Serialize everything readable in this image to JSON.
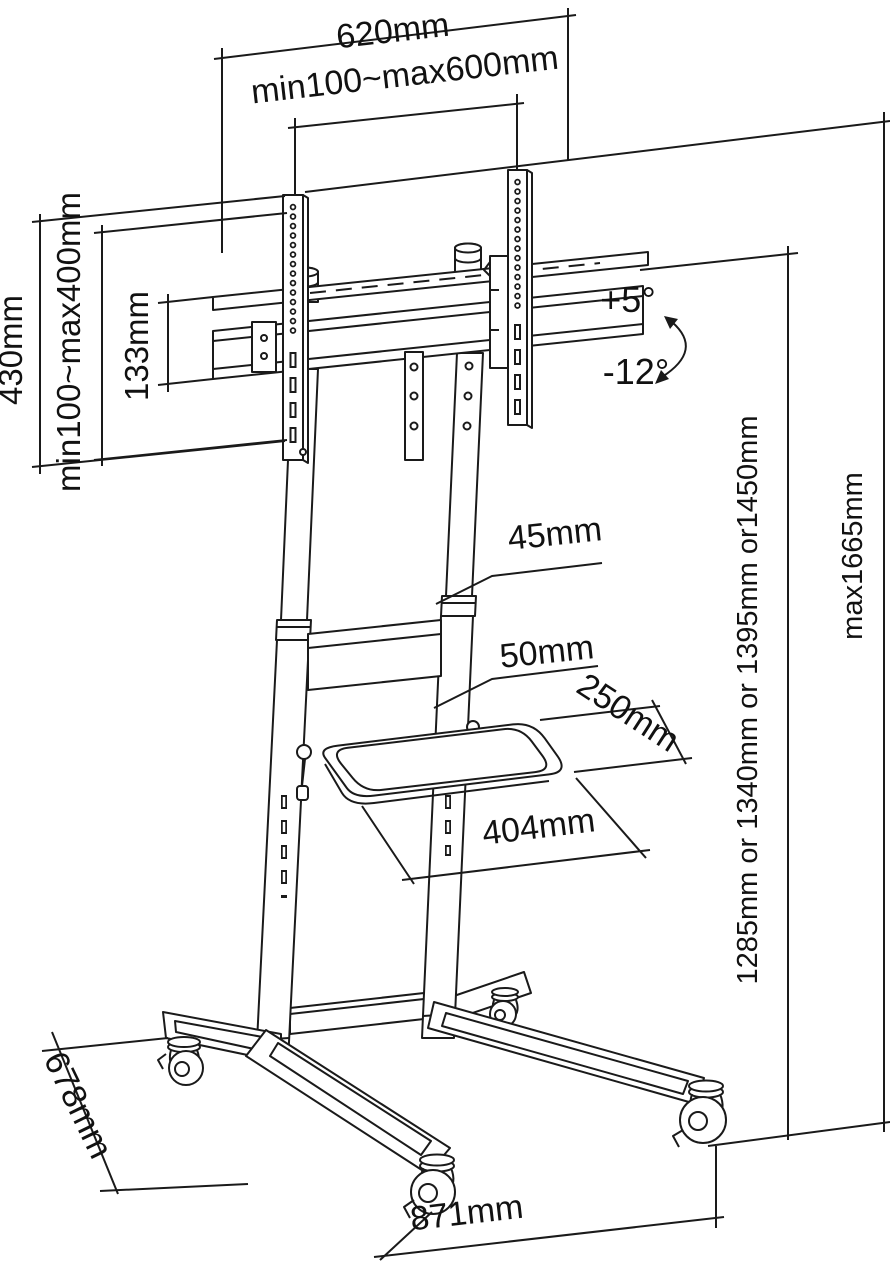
{
  "diagram": {
    "type": "technical-dimension-drawing",
    "subject": "Mobile TV floor stand with VESA bracket, shelf and casters",
    "background": "#ffffff",
    "line_color": "#1a1a1a",
    "dimensions": {
      "top_width": "620mm",
      "vesa_width": "min100~max600mm",
      "vesa_height": "min100~max400mm",
      "bracket_height": "430mm",
      "rail_spacing": "133mm",
      "tilt_up": "+5°",
      "tilt_down": "-12°",
      "upper_column_diameter": "45mm",
      "lower_column_diameter": "50mm",
      "shelf_depth": "250mm",
      "shelf_width": "404mm",
      "height_options": "1285mm or 1340mm or 1395mm or1450mm",
      "max_height": "max1665mm",
      "base_depth": "678mm",
      "base_width": "871mm"
    }
  }
}
